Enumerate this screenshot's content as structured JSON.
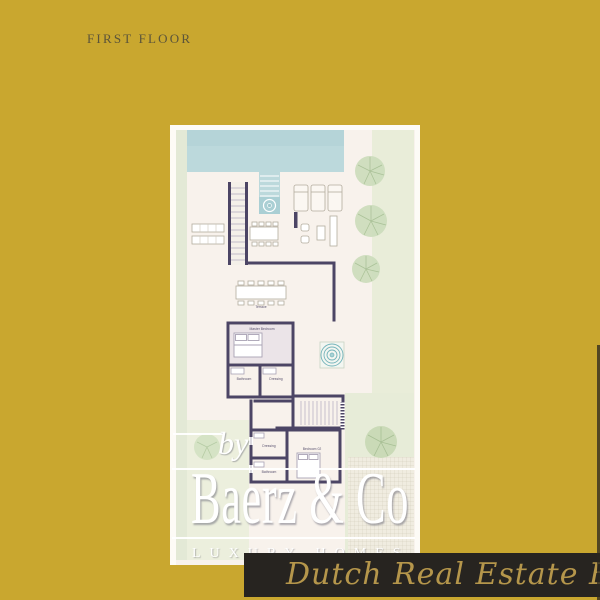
{
  "page": {
    "title": "FIRST FLOOR",
    "background_color": "#c9a72f"
  },
  "plan": {
    "labels": {
      "terrace": "Terrace",
      "master_bedroom": "Master Bedroom",
      "bathroom_1": "Bathroom",
      "dressing_1": "Dressing",
      "dressing_2": "Dressing",
      "bathroom_2": "Bathroom",
      "bedroom_02": "Bedroom 02"
    },
    "features": [
      "swimming-pool",
      "pool-steps",
      "outdoor-spa",
      "sun-loungers",
      "staircase",
      "stair-hall",
      "dining-table",
      "outdoor-dining",
      "master-bed",
      "bed",
      "outdoor-kitchen",
      "trees",
      "deck-grid",
      "jacuzzi-circle"
    ],
    "colors": {
      "wall": "#4c4565",
      "pool": "#bcd9dc",
      "garden": "#e4ead8",
      "floor": "#f8f2ec",
      "spa_ring": "#74b4ba"
    }
  },
  "branding": {
    "by": "by",
    "name": "Baerz & Co",
    "tagline": "LUXURY HOMES",
    "ribbon": "Dutch Real Estate Egypt",
    "colors": {
      "logo": "#ffffff",
      "ribbon_bg": "#272420",
      "ribbon_text": "#b5964b"
    }
  }
}
